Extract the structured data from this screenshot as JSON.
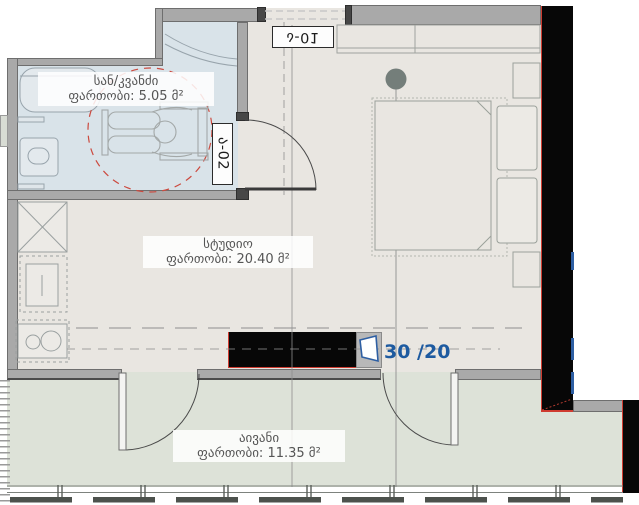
{
  "plan": {
    "rooms": {
      "bathroom": {
        "name": "სან/კვანძი",
        "area": "ფართობი: 5.05 მ²"
      },
      "studio": {
        "name": "სტუდიო",
        "area": "ფართობი: 20.40 მ²"
      },
      "balcony": {
        "name": "აივანი",
        "area": "ფართობი: 11.35 მ²"
      }
    },
    "door_tags": {
      "entry": "ა-01",
      "bathroom": "ა-02"
    },
    "ratio_label": "30 /20",
    "icons": {
      "wheelchair": "wheelchair-accessibility-symbol",
      "lamp": "ceiling-light-symbol"
    },
    "colors": {
      "studio_floor": "#e9e6e1",
      "balcony_floor": "#dde2d8",
      "bathroom_floor": "#d9e3e9",
      "wall": "#a9a9a9",
      "black_wall": "#070707",
      "red_accent": "#cf3b30",
      "blue_accent": "#2e5fa3",
      "label_text": "#555555",
      "ratio_text": "#1d5aa0"
    }
  }
}
